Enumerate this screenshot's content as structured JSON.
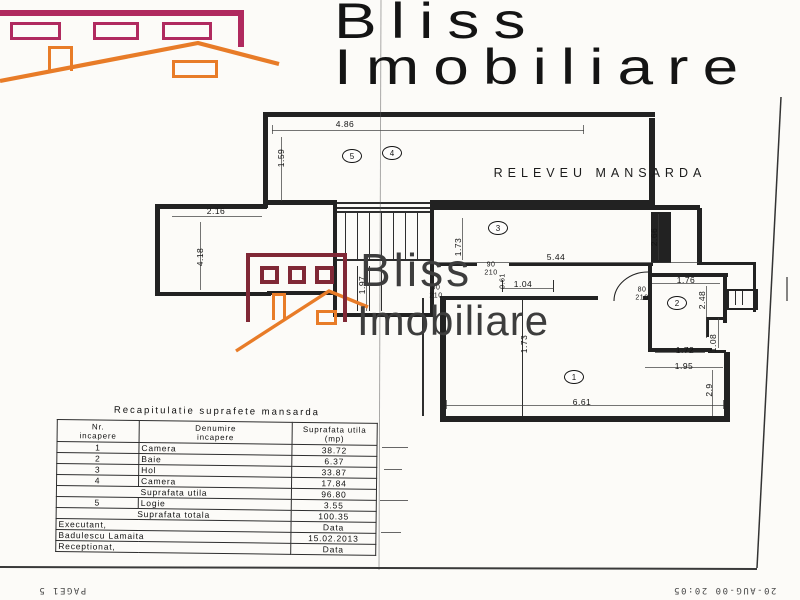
{
  "brand": {
    "line1": "Bliss",
    "line2": "Imobiliare"
  },
  "watermark": {
    "line1": "Bliss",
    "line2": "Imobiliare"
  },
  "plan": {
    "title": "RELEVEU MANSARDA",
    "rooms": [
      "1",
      "2",
      "3",
      "4",
      "5"
    ],
    "dims": {
      "d486": "4.86",
      "d159": "1.59",
      "d216": "2.16",
      "d418": "4.18",
      "d173a": "1.73",
      "d544": "5.44",
      "d266": "2.66",
      "d197": "1.97",
      "d061": "0.61",
      "d104": "1.04",
      "d176": "1.76",
      "d248": "2.48",
      "d108": "1.08",
      "d172": "1.72",
      "d195": "1.95",
      "d29": "2.9",
      "d661": "6.61",
      "d173b": "1.73"
    },
    "doors": {
      "door1a": "90",
      "door1b": "210",
      "door2a": "90",
      "door2b": "210",
      "door3a": "80",
      "door3b": "210"
    },
    "colors": {
      "magenta": "#b02a5f",
      "dark_red": "#802836",
      "orange": "#e87c28"
    }
  },
  "table": {
    "title": "Recapitulatie suprafete mansarda",
    "headers": {
      "c1a": "Nr.",
      "c1b": "incapere",
      "c2a": "Denumire",
      "c2b": "incapere",
      "c3a": "Suprafata utila",
      "c3b": "(mp)"
    },
    "rows": [
      {
        "nr": "1",
        "name": "Camera",
        "value": "38.72"
      },
      {
        "nr": "2",
        "name": "Baie",
        "value": "6.37"
      },
      {
        "nr": "3",
        "name": "Hol",
        "value": "33.87"
      },
      {
        "nr": "4",
        "name": "Camera",
        "value": "17.84"
      },
      {
        "label": "Suprafata utila",
        "value": "96.80"
      },
      {
        "nr": "5",
        "name": "Logie",
        "value": "3.55"
      },
      {
        "label": "Suprafata totala",
        "value": "100.35"
      },
      {
        "label": "Executant,",
        "value": "Data"
      },
      {
        "label": "Badulescu Lamaita",
        "value": "15.02.2013"
      },
      {
        "label": "Receptionat,",
        "value": "Data"
      }
    ]
  },
  "footer": {
    "page": "PAGE1  5",
    "timestamp": "20-AUG-00  20:05"
  }
}
